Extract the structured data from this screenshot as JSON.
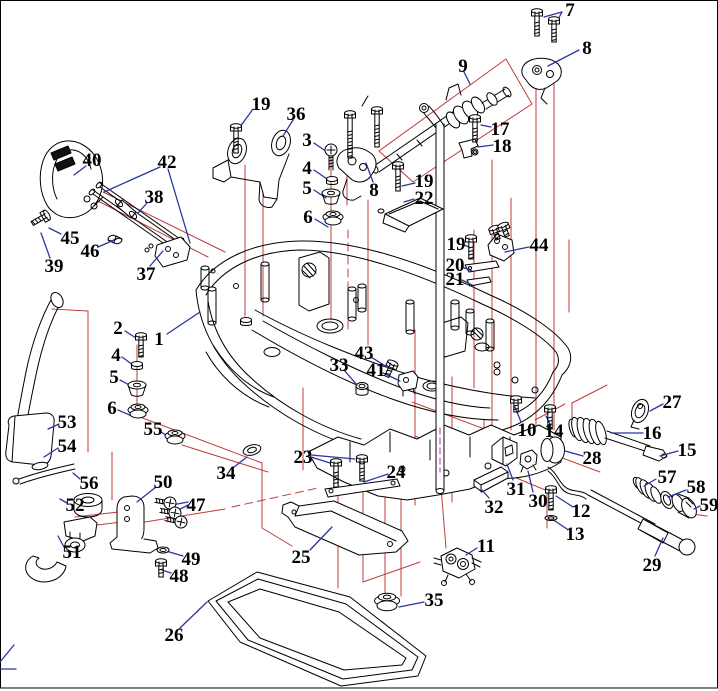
{
  "figure": {
    "kind": "exploded-parts-diagram",
    "subject": "Outboard motor bottom cowling assembly exploded view",
    "background": "#ffffff",
    "colors": {
      "part_line": "#000000",
      "callout_text": "#000000",
      "leader_line": "#2936a0",
      "group_line": "#c23b3b",
      "center_line": "#cc44cc"
    },
    "callouts": [
      {
        "n": "1",
        "x": 159,
        "y": 338,
        "leaders": [
          [
            167,
            334,
            200,
            312
          ]
        ]
      },
      {
        "n": "2",
        "x": 118,
        "y": 327,
        "leaders": [
          [
            125,
            331,
            136,
            338
          ]
        ]
      },
      {
        "n": "3",
        "x": 307,
        "y": 139,
        "leaders": [
          [
            314,
            143,
            327,
            152
          ]
        ]
      },
      {
        "n": "4",
        "x": 307,
        "y": 167,
        "leaders": [
          [
            314,
            170,
            327,
            179
          ]
        ]
      },
      {
        "n": "5",
        "x": 307,
        "y": 187,
        "leaders": [
          [
            314,
            190,
            326,
            198
          ]
        ]
      },
      {
        "n": "6",
        "x": 308,
        "y": 216,
        "leaders": [
          [
            315,
            219,
            328,
            227
          ]
        ]
      },
      {
        "n": "4",
        "x": 116,
        "y": 354,
        "leaders": [
          [
            122,
            357,
            133,
            365
          ]
        ]
      },
      {
        "n": "5",
        "x": 114,
        "y": 376,
        "leaders": [
          [
            120,
            380,
            133,
            387
          ]
        ]
      },
      {
        "n": "6",
        "x": 112,
        "y": 407,
        "leaders": [
          [
            118,
            410,
            132,
            416
          ]
        ]
      },
      {
        "n": "7",
        "x": 570,
        "y": 9,
        "leaders": [
          [
            562,
            12,
            544,
            17
          ],
          [
            562,
            12,
            556,
            23
          ]
        ]
      },
      {
        "n": "8",
        "x": 374,
        "y": 189,
        "leaders": [
          [
            373,
            182,
            366,
            163
          ]
        ]
      },
      {
        "n": "8",
        "x": 587,
        "y": 47,
        "leaders": [
          [
            579,
            50,
            548,
            66
          ]
        ]
      },
      {
        "n": "9",
        "x": 463,
        "y": 65,
        "leaders": [
          [
            464,
            72,
            470,
            84
          ]
        ]
      },
      {
        "n": "10",
        "x": 527,
        "y": 429,
        "leaders": [
          [
            521,
            422,
            515,
            407
          ]
        ]
      },
      {
        "n": "11",
        "x": 486,
        "y": 545,
        "leaders": [
          [
            477,
            548,
            466,
            555
          ]
        ]
      },
      {
        "n": "12",
        "x": 581,
        "y": 510,
        "leaders": [
          [
            573,
            507,
            556,
            496
          ]
        ]
      },
      {
        "n": "13",
        "x": 575,
        "y": 533,
        "leaders": [
          [
            567,
            529,
            552,
            519
          ]
        ]
      },
      {
        "n": "14",
        "x": 554,
        "y": 430,
        "leaders": [
          [
            550,
            424,
            546,
            416
          ]
        ]
      },
      {
        "n": "15",
        "x": 687,
        "y": 449,
        "leaders": [
          [
            678,
            451,
            660,
            456
          ]
        ]
      },
      {
        "n": "16",
        "x": 652,
        "y": 432,
        "leaders": [
          [
            643,
            433,
            611,
            433
          ]
        ]
      },
      {
        "n": "17",
        "x": 500,
        "y": 128,
        "leaders": [
          [
            491,
            127,
            481,
            125
          ]
        ]
      },
      {
        "n": "18",
        "x": 502,
        "y": 145,
        "leaders": [
          [
            493,
            145,
            478,
            147
          ]
        ]
      },
      {
        "n": "19",
        "x": 261,
        "y": 103,
        "leaders": [
          [
            253,
            109,
            240,
            127
          ]
        ]
      },
      {
        "n": "19",
        "x": 424,
        "y": 180,
        "leaders": [
          [
            415,
            183,
            402,
            186
          ]
        ]
      },
      {
        "n": "19",
        "x": 456,
        "y": 243,
        "leaders": [
          [
            464,
            245,
            469,
            247
          ]
        ]
      },
      {
        "n": "20",
        "x": 455,
        "y": 264,
        "leaders": [
          [
            462,
            267,
            472,
            271
          ]
        ]
      },
      {
        "n": "21",
        "x": 455,
        "y": 278,
        "leaders": [
          [
            462,
            280,
            472,
            285
          ]
        ]
      },
      {
        "n": "22",
        "x": 424,
        "y": 197,
        "leaders": [
          [
            414,
            199,
            404,
            202
          ]
        ]
      },
      {
        "n": "23",
        "x": 303,
        "y": 456,
        "leaders": [
          [
            311,
            457,
            330,
            463
          ],
          [
            311,
            455,
            355,
            459
          ]
        ]
      },
      {
        "n": "24",
        "x": 396,
        "y": 471,
        "leaders": [
          [
            388,
            474,
            364,
            482
          ]
        ]
      },
      {
        "n": "25",
        "x": 301,
        "y": 556,
        "leaders": [
          [
            310,
            550,
            332,
            527
          ]
        ]
      },
      {
        "n": "26",
        "x": 174,
        "y": 634,
        "leaders": [
          [
            180,
            628,
            207,
            602
          ]
        ]
      },
      {
        "n": "27",
        "x": 672,
        "y": 401,
        "leaders": [
          [
            663,
            404,
            650,
            411
          ]
        ]
      },
      {
        "n": "28",
        "x": 592,
        "y": 457,
        "leaders": [
          [
            583,
            456,
            565,
            451
          ]
        ]
      },
      {
        "n": "29",
        "x": 652,
        "y": 564,
        "leaders": [
          [
            655,
            556,
            663,
            538
          ]
        ]
      },
      {
        "n": "30",
        "x": 538,
        "y": 500,
        "leaders": [
          [
            533,
            492,
            528,
            471
          ]
        ]
      },
      {
        "n": "31",
        "x": 516,
        "y": 488,
        "leaders": [
          [
            513,
            480,
            507,
            464
          ]
        ]
      },
      {
        "n": "32",
        "x": 494,
        "y": 506,
        "leaders": [
          [
            489,
            498,
            481,
            489
          ]
        ]
      },
      {
        "n": "33",
        "x": 339,
        "y": 364,
        "leaders": [
          [
            344,
            370,
            357,
            385
          ]
        ]
      },
      {
        "n": "34",
        "x": 226,
        "y": 472,
        "leaders": [
          [
            234,
            467,
            247,
            457
          ]
        ]
      },
      {
        "n": "35",
        "x": 434,
        "y": 599,
        "leaders": [
          [
            424,
            602,
            399,
            607
          ]
        ]
      },
      {
        "n": "36",
        "x": 296,
        "y": 113,
        "leaders": [
          [
            293,
            120,
            283,
            136
          ]
        ]
      },
      {
        "n": "37",
        "x": 146,
        "y": 273,
        "leaders": [
          [
            150,
            266,
            163,
            251
          ]
        ]
      },
      {
        "n": "38",
        "x": 154,
        "y": 196,
        "leaders": [
          [
            147,
            203,
            138,
            213
          ]
        ]
      },
      {
        "n": "39",
        "x": 54,
        "y": 265,
        "leaders": [
          [
            50,
            258,
            41,
            233
          ]
        ]
      },
      {
        "n": "40",
        "x": 92,
        "y": 159,
        "leaders": [
          [
            86,
            166,
            74,
            175
          ]
        ]
      },
      {
        "n": "41",
        "x": 376,
        "y": 369,
        "leaders": [
          [
            383,
            373,
            400,
            381
          ]
        ]
      },
      {
        "n": "42",
        "x": 167,
        "y": 161,
        "leaders": [
          [
            160,
            167,
            104,
            192
          ],
          [
            168,
            169,
            190,
            243
          ]
        ]
      },
      {
        "n": "43",
        "x": 364,
        "y": 352,
        "leaders": [
          [
            371,
            357,
            390,
            369
          ]
        ]
      },
      {
        "n": "44",
        "x": 539,
        "y": 244,
        "leaders": [
          [
            529,
            247,
            505,
            252
          ]
        ]
      },
      {
        "n": "45",
        "x": 70,
        "y": 237,
        "leaders": [
          [
            61,
            234,
            49,
            228
          ]
        ]
      },
      {
        "n": "46",
        "x": 90,
        "y": 250,
        "leaders": [
          [
            98,
            247,
            114,
            240
          ]
        ]
      },
      {
        "n": "47",
        "x": 196,
        "y": 504,
        "leaders": [
          [
            188,
            502,
            172,
            505
          ],
          [
            188,
            505,
            173,
            513
          ]
        ]
      },
      {
        "n": "48",
        "x": 179,
        "y": 575,
        "leaders": [
          [
            171,
            573,
            162,
            570
          ]
        ]
      },
      {
        "n": "49",
        "x": 191,
        "y": 558,
        "leaders": [
          [
            183,
            556,
            166,
            551
          ]
        ]
      },
      {
        "n": "50",
        "x": 163,
        "y": 481,
        "leaders": [
          [
            156,
            487,
            137,
            502
          ]
        ]
      },
      {
        "n": "51",
        "x": 72,
        "y": 551,
        "leaders": [
          [
            64,
            547,
            58,
            536
          ]
        ]
      },
      {
        "n": "52",
        "x": 75,
        "y": 504,
        "leaders": [
          [
            67,
            503,
            60,
            499
          ]
        ]
      },
      {
        "n": "53",
        "x": 67,
        "y": 421,
        "leaders": [
          [
            59,
            424,
            48,
            429
          ]
        ]
      },
      {
        "n": "54",
        "x": 67,
        "y": 445,
        "leaders": [
          [
            58,
            448,
            44,
            457
          ]
        ]
      },
      {
        "n": "55",
        "x": 153,
        "y": 428,
        "leaders": [
          [
            161,
            432,
            172,
            439
          ]
        ]
      },
      {
        "n": "56",
        "x": 89,
        "y": 482,
        "leaders": [
          [
            80,
            479,
            73,
            473
          ]
        ]
      },
      {
        "n": "57",
        "x": 667,
        "y": 476,
        "leaders": [
          [
            656,
            479,
            644,
            486
          ]
        ]
      },
      {
        "n": "58",
        "x": 696,
        "y": 486,
        "leaders": [
          [
            686,
            490,
            668,
            497
          ]
        ]
      },
      {
        "n": "59",
        "x": 709,
        "y": 504,
        "leaders": [
          [
            700,
            506,
            694,
            509
          ]
        ]
      }
    ]
  }
}
